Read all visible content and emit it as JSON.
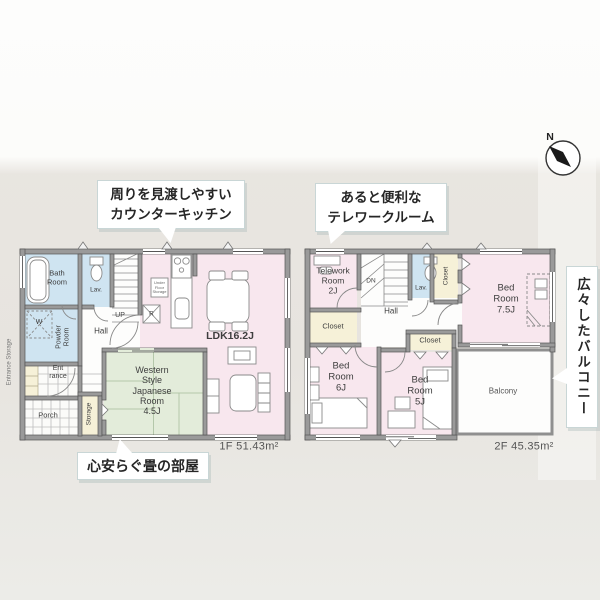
{
  "colors": {
    "room_pink": "#f8e7ee",
    "room_blue": "#cfe4f1",
    "room_green": "#e3ecda",
    "room_cream": "#f6f1d8",
    "floor_white": "#fdfdfc",
    "wall_gray": "#9a9a9a",
    "background": "#e8e5e0"
  },
  "compass": {
    "label": "N"
  },
  "annotations": {
    "kitchen": {
      "line1": "周りを見渡しやすい",
      "line2": "カウンターキッチン"
    },
    "telework": {
      "line1": "あると便利な",
      "line2": "テレワークルーム"
    },
    "balcony": {
      "text": "広々したバルコニー"
    },
    "tatami": {
      "text": "心安らぐ畳の部屋"
    }
  },
  "floor1": {
    "area_label": "1F 51.43m²",
    "labels": {
      "bath": "Bath\nRoom",
      "lav": "Lav.",
      "washer": "W",
      "powder": "Powder\nRoom",
      "hall": "Hall",
      "up": "UP",
      "entrance": "Ent\nrance",
      "porch": "Porch",
      "storage": "Storage",
      "entrance_storage": "Entrance Storage",
      "ldk": "LDK16.2J",
      "japanese": "Western\nStyle\nJapanese\nRoom\n4.5J",
      "fridge": "R",
      "underfloor": "Under\nFloor\nStorage"
    }
  },
  "floor2": {
    "area_label": "2F 45.35m²",
    "labels": {
      "telework": "Telework\nRoom\n2J",
      "dn": "DN",
      "lav": "Lav.",
      "closet_right": "Closet",
      "bed75": "Bed\nRoom\n7.5J",
      "closet_left": "Closet",
      "hall": "Hall",
      "closet_mid": "Closet",
      "bed6": "Bed\nRoom\n6J",
      "bed5": "Bed\nRoom\n5J",
      "balcony": "Balcony"
    }
  }
}
